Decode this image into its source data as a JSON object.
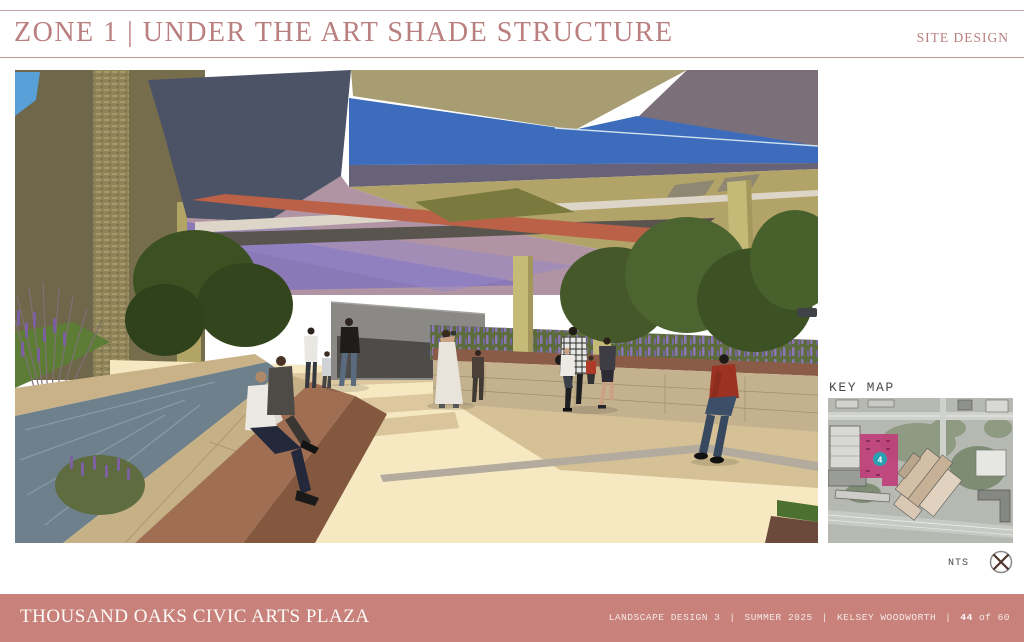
{
  "header": {
    "title": "ZONE 1 | UNDER THE ART SHADE STRUCTURE",
    "section_label": "SITE DESIGN",
    "accent_color": "#ba7f7f"
  },
  "main_render": {
    "alt_label": "Perspective rendering of Zone 1 plaza beneath the angular art shade structure with water runnel, seat walls, planting, and people"
  },
  "key_map": {
    "label": "KEY MAP",
    "zone_marker": "4",
    "zone_highlight_color": "#c03d78",
    "marker_color": "#29a0b1",
    "scale_note": "NTS"
  },
  "footer": {
    "bar_color": "#c8827b",
    "project_title": "THOUSAND OAKS CIVIC ARTS PLAZA",
    "course": "LANDSCAPE DESIGN 3",
    "term": "SUMMER 2025",
    "author": "KELSEY WOODWORTH",
    "separator": "|",
    "page_current": "44",
    "page_suffix": "of 60"
  }
}
